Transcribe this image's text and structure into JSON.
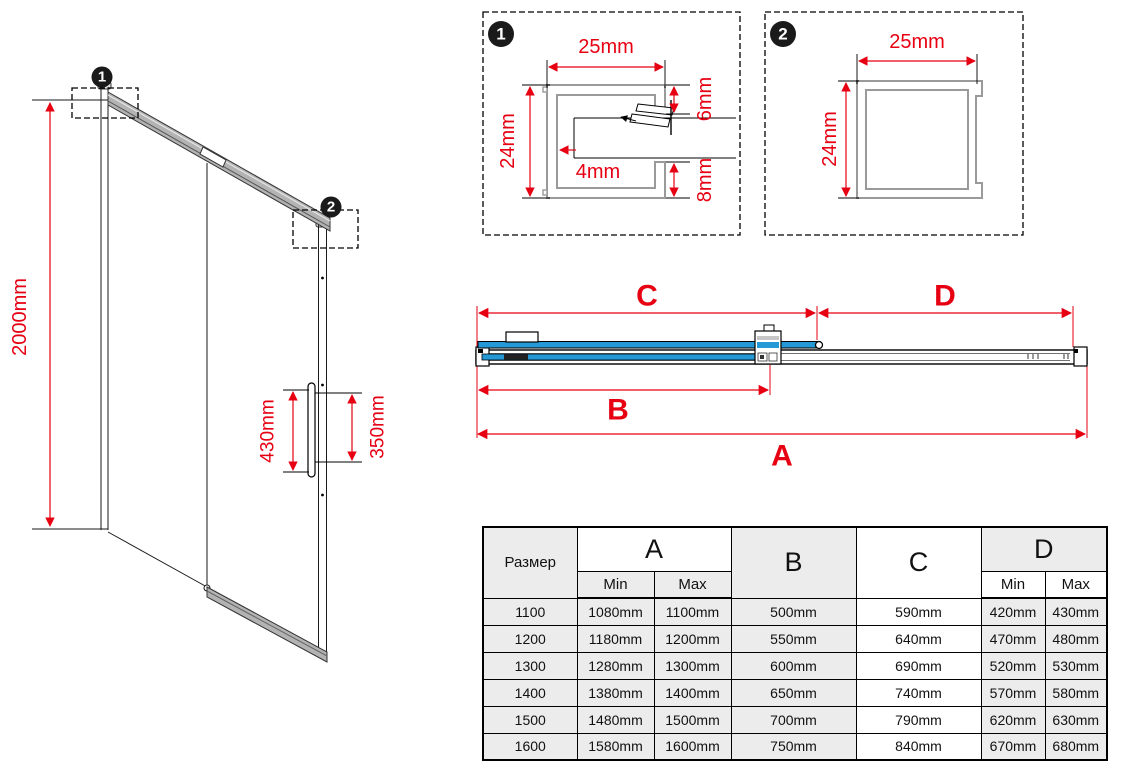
{
  "colors": {
    "dimension_red": "#e60012",
    "glass_blue": "#2499d6",
    "profile_gray": "#9a9a9a",
    "table_gray": "#ececec"
  },
  "iso_drawing": {
    "badge_1": "1",
    "badge_2": "2",
    "height_dim": "2000mm",
    "handle_length_dim": "430mm",
    "handle_holes_dim": "350mm"
  },
  "detail_1": {
    "badge": "1",
    "width_dim": "25mm",
    "height_dim": "24mm",
    "top_lip_dim": "6mm",
    "bottom_lip_dim": "8mm",
    "glass_gap_dim": "4mm"
  },
  "detail_2": {
    "badge": "2",
    "width_dim": "25mm",
    "height_dim": "24mm"
  },
  "section_view": {
    "dim_a": "A",
    "dim_b": "B",
    "dim_c": "C",
    "dim_d": "D"
  },
  "table": {
    "header": {
      "size": "Размер",
      "a": "A",
      "b": "B",
      "c": "C",
      "d": "D",
      "min": "Min",
      "max": "Max"
    },
    "rows": [
      {
        "size": "1100",
        "a_min": "1080mm",
        "a_max": "1100mm",
        "b": "500mm",
        "c": "590mm",
        "d_min": "420mm",
        "d_max": "430mm"
      },
      {
        "size": "1200",
        "a_min": "1180mm",
        "a_max": "1200mm",
        "b": "550mm",
        "c": "640mm",
        "d_min": "470mm",
        "d_max": "480mm"
      },
      {
        "size": "1300",
        "a_min": "1280mm",
        "a_max": "1300mm",
        "b": "600mm",
        "c": "690mm",
        "d_min": "520mm",
        "d_max": "530mm"
      },
      {
        "size": "1400",
        "a_min": "1380mm",
        "a_max": "1400mm",
        "b": "650mm",
        "c": "740mm",
        "d_min": "570mm",
        "d_max": "580mm"
      },
      {
        "size": "1500",
        "a_min": "1480mm",
        "a_max": "1500mm",
        "b": "700mm",
        "c": "790mm",
        "d_min": "620mm",
        "d_max": "630mm"
      },
      {
        "size": "1600",
        "a_min": "1580mm",
        "a_max": "1600mm",
        "b": "750mm",
        "c": "840mm",
        "d_min": "670mm",
        "d_max": "680mm"
      }
    ]
  }
}
